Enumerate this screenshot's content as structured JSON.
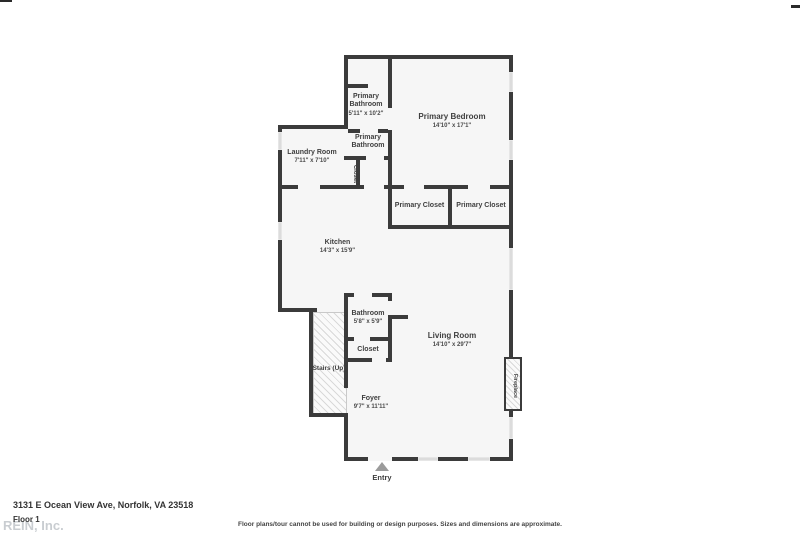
{
  "page": {
    "address": "3131 E Ocean View Ave, Norfolk, VA 23518",
    "floor_label": "Floor 1",
    "watermark": "REIN, Inc.",
    "disclaimer": "Floor plans/tour cannot be used for building or design purposes. Sizes and dimensions are approximate."
  },
  "rooms": {
    "primary_bathroom_top": {
      "label": "Primary Bathroom",
      "dims": "5'11\" x 10'2\""
    },
    "primary_bedroom": {
      "label": "Primary Bedroom",
      "dims": "14'10\" x 17'1\""
    },
    "laundry_room": {
      "label": "Laundry Room",
      "dims": "7'11\" x 7'10\""
    },
    "primary_bathroom_mid": {
      "label": "Primary Bathroom"
    },
    "hall_closet": {
      "label": "Closet"
    },
    "primary_closet_left": {
      "label": "Primary Closet"
    },
    "primary_closet_right": {
      "label": "Primary Closet"
    },
    "kitchen": {
      "label": "Kitchen",
      "dims": "14'3\" x 15'9\""
    },
    "bathroom": {
      "label": "Bathroom",
      "dims": "5'8\" x 5'9\""
    },
    "foyer_closet": {
      "label": "Closet"
    },
    "stairs": {
      "label": "Stairs (Up)"
    },
    "living_room": {
      "label": "Living Room",
      "dims": "14'10\" x 29'7\""
    },
    "foyer": {
      "label": "Foyer",
      "dims": "9'7\" x 11'11\""
    },
    "fireplace": {
      "label": "Fireplace"
    },
    "entry": {
      "label": "Entry"
    }
  },
  "colors": {
    "wall": "#3b3b3b",
    "room_fill": "#f6f6f6",
    "window": "#dcdcdc",
    "label_text": "#3f3f3f",
    "watermark": "#c9cdd1",
    "entry_arrow": "#9b9b9b"
  }
}
